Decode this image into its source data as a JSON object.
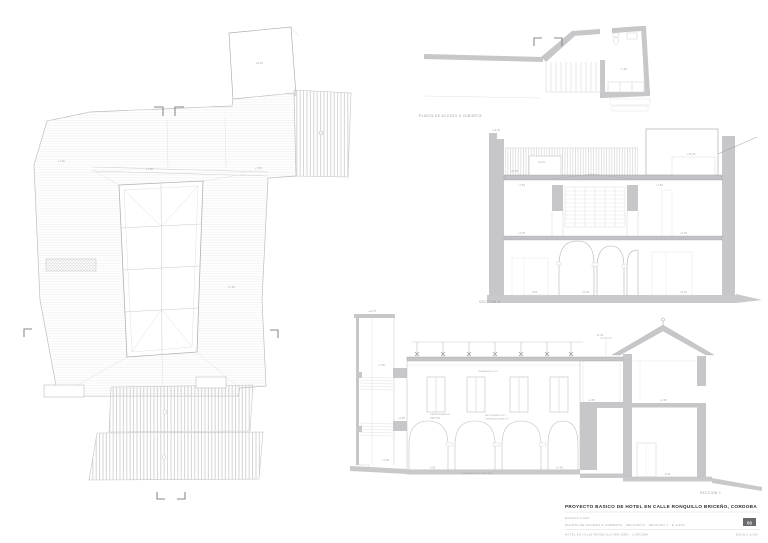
{
  "sheet": {
    "captions": {
      "roof_access_plan": "PLANTA DE ACCESO A CUBIERTA",
      "section_a": "SECCION A",
      "section_1": "SECCION 1"
    },
    "titleblock": {
      "project_title": "PROYECTO BASICO DE HOTEL EN CALLE RONQUILLO BRICEÑO, CORDOBA",
      "scale_row": "ESCALA   1/100",
      "contents_row": "PLANTA DE ACCESO A CUBIERTA · SECCION A · SECCION 1 · E 1/100",
      "sheet_number": "03",
      "footer_left": "HOTEL EN CALLE RONQUILLO BRICEÑO · CORDOBA",
      "footer_right": "ESCALA 1/100"
    },
    "roof_plan_levels": {
      "l1": "+7,30",
      "l2": "+7,65",
      "l3": "+7,65",
      "l4": "+8,15",
      "l5": "+7,65"
    },
    "roof_access_levels": {
      "room": "+7,65"
    },
    "section_a_ann": {
      "parapet": "+11,70",
      "deck_l": "+7,56",
      "deck_r": "+7,56",
      "planter": "+9,15",
      "hatch": "+8,70",
      "caseton": "+10,45",
      "mid_l": "+3,78",
      "mid_r": "+3,78",
      "g1": "0,00",
      "g2": "+0,15",
      "g3": "+0,30"
    },
    "section_1_ann": {
      "tower_top": "+11,70",
      "t1": "+7,65",
      "t2": "+4,05",
      "t3": "+1,35",
      "deck_dim": "11,15",
      "deck_label": "TERRAZA DE SOL",
      "note1a": "CARPINTERIA DE",
      "note1b": "MADERA",
      "note2a": "RECUPERACION Y",
      "note2b": "LIMPIEZA DE ARCOS",
      "floor_note": "LINEA DE MURO ORIGINAL",
      "f1": "0,00",
      "f2": "+0,45",
      "m1": "+4,05",
      "h1": "+3,60",
      "h2": "-0,35"
    },
    "colors": {
      "poche": "#c7c7ca",
      "ground": "#c9c9cc",
      "line": "#b9b9bd",
      "caption_text": "#98989c",
      "title_text": "#2e2e32",
      "sheet_box": "#6a6a6e"
    }
  }
}
